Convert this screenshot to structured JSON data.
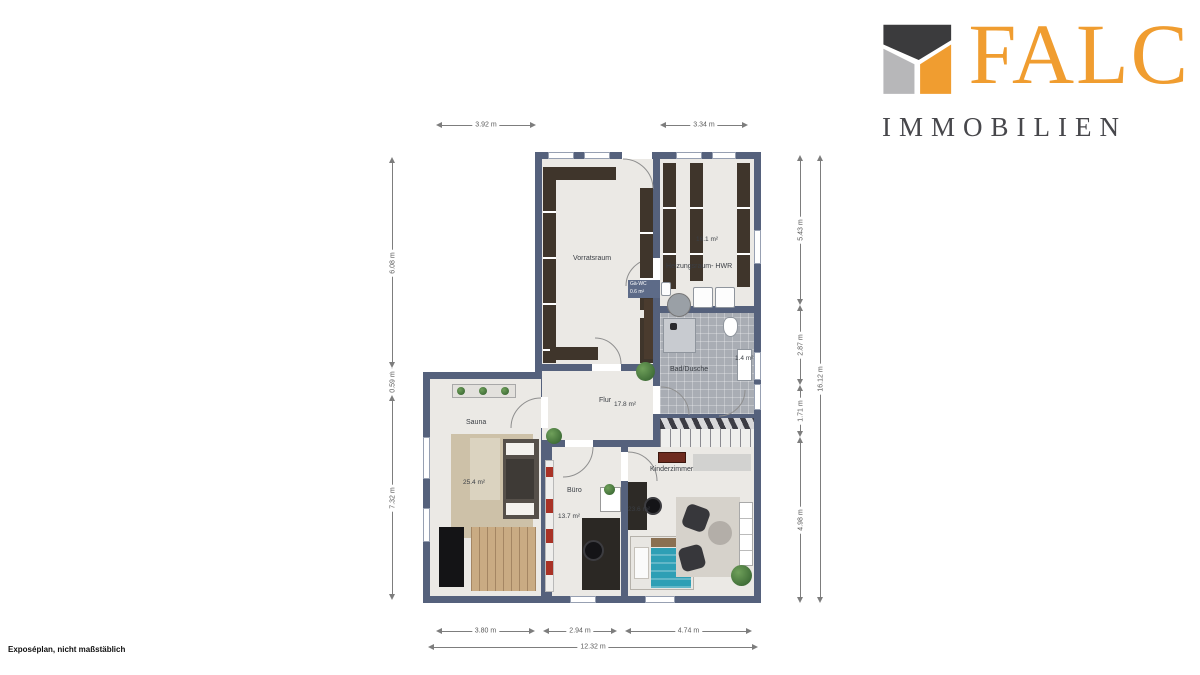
{
  "logo": {
    "brand": "FALC",
    "subtitle": "IMMOBILIEN"
  },
  "footer": {
    "note": "Exposéplan, nicht maßstäblich"
  },
  "plan": {
    "rooms": {
      "vorratsraum": {
        "name": "Vorratsraum"
      },
      "heizungsraum": {
        "name": "Heizungsraum- HWR",
        "area": "16.1 m²"
      },
      "bad": {
        "name": "Bad/Dusche",
        "area": "1.4 m²"
      },
      "flur": {
        "name": "Flur",
        "area": "17.8 m²"
      },
      "sauna": {
        "name": "Sauna",
        "area": "25.4 m²"
      },
      "buero": {
        "name": "Büro",
        "area": "13.7 m²"
      },
      "kinderzimmer": {
        "name": "Kinderzimmer",
        "area": "23.6 m²"
      },
      "wall_tag": {
        "name": "Gä-WC",
        "area": "0.6 m²"
      }
    },
    "dims": {
      "top": [
        "3.92 m",
        "3.34 m"
      ],
      "left": [
        "6.08 m",
        "0.59 m",
        "7.32 m"
      ],
      "right": [
        "5.43 m",
        "2.87 m",
        "1.71 m",
        "4.98 m"
      ],
      "right_total": "16.12 m",
      "bottom": [
        "3.80 m",
        "2.94 m",
        "4.74 m"
      ],
      "bottom_total": "12.32 m"
    },
    "colors": {
      "wall": "#55617C",
      "floor": "#EBE9E5",
      "bath_tile": "#A9ADB4",
      "brand_orange": "#F09D30",
      "brand_dark": "#47474B",
      "bed_teal": "#2E9FB5"
    }
  }
}
